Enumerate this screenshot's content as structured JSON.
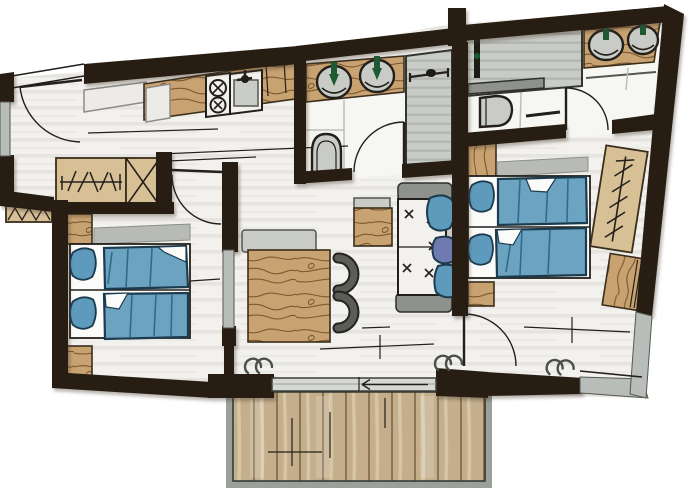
{
  "title": "Hand-drawn apartment floor plan with two bedrooms, two bathrooms, kitchenette, living-dining area and balcony",
  "type": "floor-plan-illustration",
  "colors": {
    "wall": "#281d12",
    "ink": "#23201b",
    "floor": "#f2f1ee",
    "floor_stripe": "#e3e1dc",
    "tile": "#f6f6f3",
    "tile_line": "#bcbfb9",
    "wood": "#c8a271",
    "wood_grain": "#7c5a31",
    "wood_edge": "#3a2d1a",
    "wood_light": "#d8c096",
    "deck": "#c4ae8c",
    "deck_line": "#8a7554",
    "deck_streak": "#e3d5b8",
    "shower": "#c8cbc6",
    "shower_stripe": "#b2b6b0",
    "window": "#b9bdb9",
    "fixture": "#c9cbc6",
    "fixture_dark": "#8f928c",
    "fixture_edge": "#55584f",
    "bed_blue": "#6ba3c1",
    "bed_fold": "#2f6b8e",
    "bed_edge": "#1d3b4e",
    "pillow": "#5d9abc",
    "pillow_purple": "#6f7bb0",
    "headboard": "#b8bbb5",
    "faucet": "#1d5a33",
    "paper": "#fbfbf9",
    "frame": "#9ba09a",
    "slider": "#d6d8d4"
  },
  "rooms": [
    {
      "id": "hallway",
      "label": "Entrance hall",
      "furniture": [
        "entrance-door",
        "wardrobe-with-hangers",
        "luggage-rack",
        "shelf"
      ]
    },
    {
      "id": "kitchen",
      "label": "Kitchenette",
      "furniture": [
        "wood-counter",
        "two-ring-cooktop",
        "sink",
        "appliance"
      ]
    },
    {
      "id": "bathroom-main",
      "label": "Bathroom 1",
      "furniture": [
        "double-washbasin",
        "toilet",
        "shower"
      ]
    },
    {
      "id": "bathroom-second",
      "label": "Bathroom 2",
      "furniture": [
        "shower",
        "toilet",
        "double-washbasin"
      ]
    },
    {
      "id": "bedroom-left",
      "label": "Bedroom 1",
      "furniture": [
        "twin-beds",
        "pillows",
        "duvets",
        "nightstands",
        "headboard"
      ]
    },
    {
      "id": "bedroom-right",
      "label": "Bedroom 2",
      "furniture": [
        "twin-beds",
        "pillows",
        "duvets",
        "cabinet",
        "nightstand",
        "wardrobe-with-hangers",
        "dresser"
      ]
    },
    {
      "id": "living-dining",
      "label": "Living / dining area",
      "furniture": [
        "dining-table",
        "two-chairs",
        "bench",
        "coffee-table",
        "sofa-with-cushions"
      ]
    },
    {
      "id": "balcony",
      "label": "Balcony terrace",
      "furniture": [
        "wood-deck",
        "sliding-door",
        "railing"
      ]
    }
  ]
}
